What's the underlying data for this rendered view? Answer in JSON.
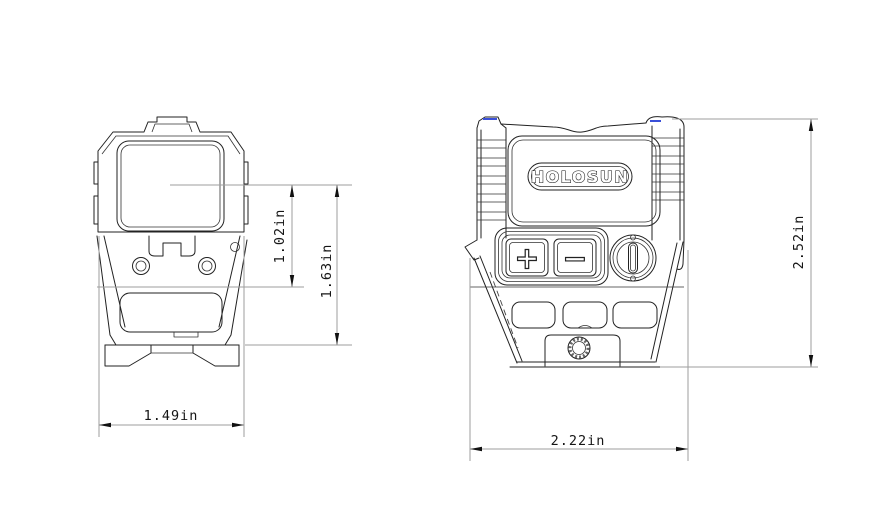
{
  "colors": {
    "background": "#ffffff",
    "outline": "#222222",
    "dimension_line": "#9e9e9e",
    "arrow": "#111111",
    "text": "#151515",
    "accent_blue": "#3a4fd8"
  },
  "front_view": {
    "dimensions": {
      "lens_center_to_base": "1.02in",
      "lens_center_to_rail": "1.63in",
      "width": "1.49in"
    }
  },
  "side_view": {
    "logo_text": "HOLOSUN",
    "brightness_up_label": "+",
    "brightness_down_label": "−",
    "dimensions": {
      "length": "2.22in",
      "height": "2.52in"
    }
  }
}
